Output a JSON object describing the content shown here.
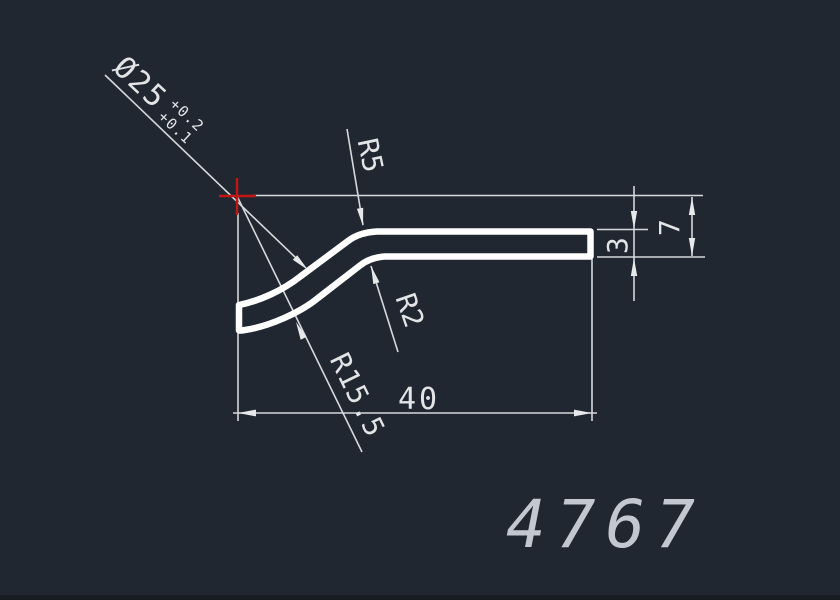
{
  "drawing": {
    "number": "4767",
    "dims": {
      "diameter": "Ø25",
      "diameter_tol_upper": "+0.2",
      "diameter_tol_lower": "+0.1",
      "radius_outer": "R5",
      "radius_inner": "R2",
      "radius_bend": "R15.5",
      "length": "40",
      "thickness": "3",
      "height": "7"
    },
    "colors": {
      "background": "#212731",
      "dimension_lines": "#d5d9dc",
      "profile_outline": "#ffffff",
      "center_marker": "#c41414",
      "number_text": "#c3c8d0"
    }
  }
}
